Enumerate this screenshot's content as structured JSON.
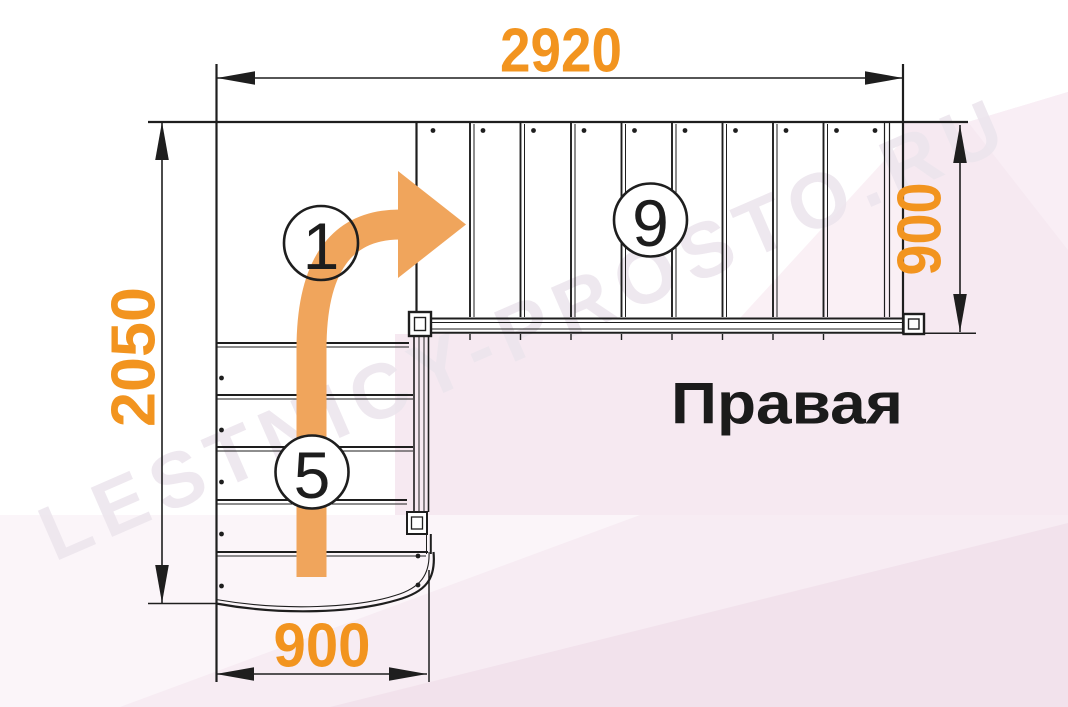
{
  "watermark": "LESTNICY-PROSTO.RU",
  "title_label": "Правая",
  "dimensions": {
    "top": "2920",
    "left": "2050",
    "bottom": "900",
    "right": "900"
  },
  "step_markers": {
    "start": "1",
    "lower_flight": "5",
    "upper_flight": "9"
  },
  "colors": {
    "dimension_text": "#F2941F",
    "direction_arrow": "#F0A55C",
    "drawing_line": "#1E1E1E",
    "background_pink": "#F6E9F1"
  }
}
